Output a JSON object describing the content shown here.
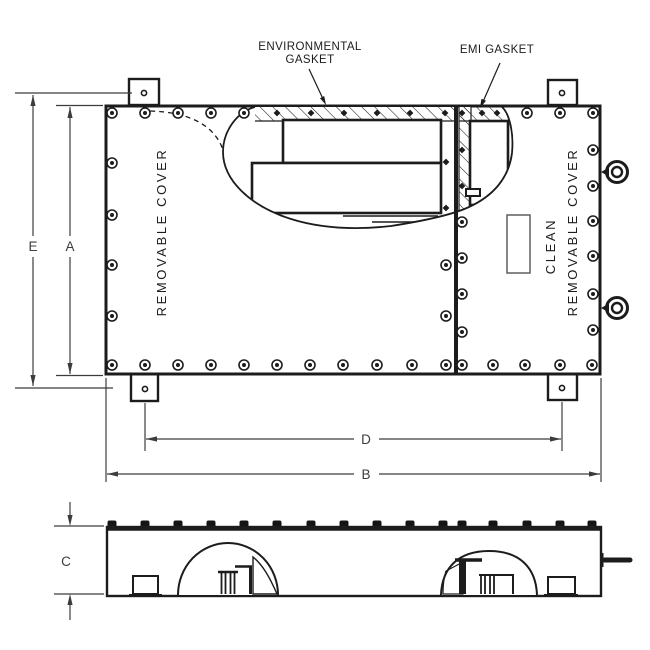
{
  "drawing": {
    "callouts": {
      "environmental_gasket_line1": "ENVIRONMENTAL",
      "environmental_gasket_line2": "GASKET",
      "emi_gasket": "EMI GASKET"
    },
    "covers": {
      "left_cover": "REMOVABLE COVER",
      "right_cover_line1": "CLEAN",
      "right_cover_line2": "REMOVABLE COVER"
    },
    "dimensions": {
      "overall_height": "E",
      "cover_height": "A",
      "overall_width": "B",
      "mounting_hole_span": "D",
      "depth": "C"
    },
    "colors": {
      "line": "#1c1c1c",
      "dimension_line": "#3c3c3c",
      "nameplate_outline": "#5f5f5f",
      "background": "#ffffff"
    }
  }
}
